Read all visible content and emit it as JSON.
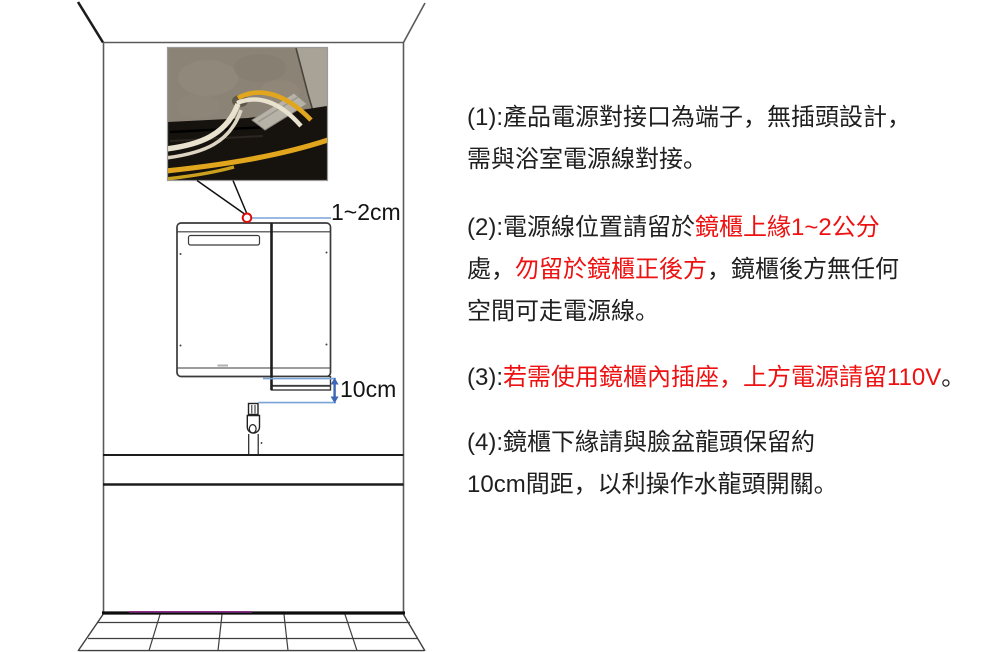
{
  "diagram": {
    "dim_top_label": "1~2cm",
    "dim_bottom_label": "10cm",
    "photo_subject": "wiring-terminals-photo",
    "marker": "power-line-position-marker"
  },
  "instructions": {
    "item1": {
      "prefix": "(1):",
      "text": "產品電源對接口為端子，無插頭設計，\n需與浴室電源線對接。"
    },
    "item2": {
      "prefix": "(2):",
      "black1": "電源線位置請留於",
      "red1": "鏡櫃上緣1~2公分",
      "black2": "\n處，",
      "red2": "勿留於鏡櫃正後方",
      "black3": "，鏡櫃後方無任何\n空間可走電源線。"
    },
    "item3": {
      "prefix": "(3):",
      "red1": "若需使用鏡櫃內插座，上方電源請留110V",
      "black1": "。"
    },
    "item4": {
      "prefix": "(4):",
      "text": "鏡櫃下緣請與臉盆龍頭保留約\n10cm間距，以利操作水龍頭開關。"
    }
  },
  "colors": {
    "black_text": "#1f1f1f",
    "red_text": "#ee1111",
    "dim_line_blue": "#7aa3d6",
    "arrow_blue": "#3a66b5",
    "marker_red": "#e00b0b",
    "floor_accent_purple": "#8b2f8b",
    "cable_yellow": "#e2a51e",
    "cable_white": "#e9e2cf"
  }
}
